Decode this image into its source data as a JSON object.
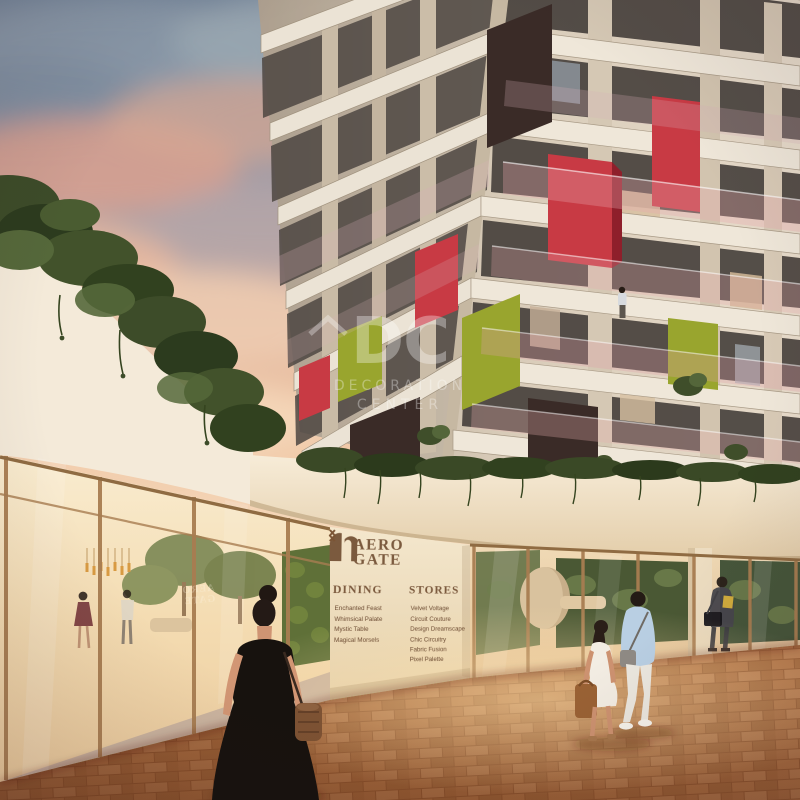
{
  "watermark": {
    "logo": "DC",
    "line1": "DECORATION",
    "line2": "CENTER"
  },
  "signage": {
    "brand": {
      "line1": "AERO",
      "line2": "GATE"
    },
    "dining": {
      "title": "DINING",
      "items": [
        "Enchanted Feast",
        "Whimsical Palate",
        "Mystic Table",
        "Magical Morsels"
      ]
    },
    "stores": {
      "title": "STORES",
      "items": [
        "Velvet Voltage",
        "Circuit Couture",
        "Design Dreamscape",
        "Chic Circuitry",
        "Fabric Fusion",
        "Pixel Palette"
      ]
    }
  },
  "icons": {
    "watermark_chevron": "chevron-up-icon",
    "dining_chevron": "chevron-left-icon",
    "stores_chevron": "chevron-right-icon",
    "brand_mark": "double-arch-icon"
  },
  "palette": {
    "brand_brown": "#7b5a3e",
    "sign_wall": "#f0e1c6",
    "accent_red": "#c83a44",
    "accent_green": "#99a52e",
    "accent_dark": "#3a2b27",
    "facade_cream": "#d7cab6",
    "slab_white": "#ebe3d5",
    "sky_top": "#76879b",
    "cloud_pink": "#e2a28e",
    "glow_peach": "#f4cfae",
    "ivy_green": "#42522b",
    "glass_warm": "#f5ddb8",
    "mullion_bronze": "#a87d51",
    "pavement_brick": "#b0713f",
    "dress_black": "#17120e"
  }
}
